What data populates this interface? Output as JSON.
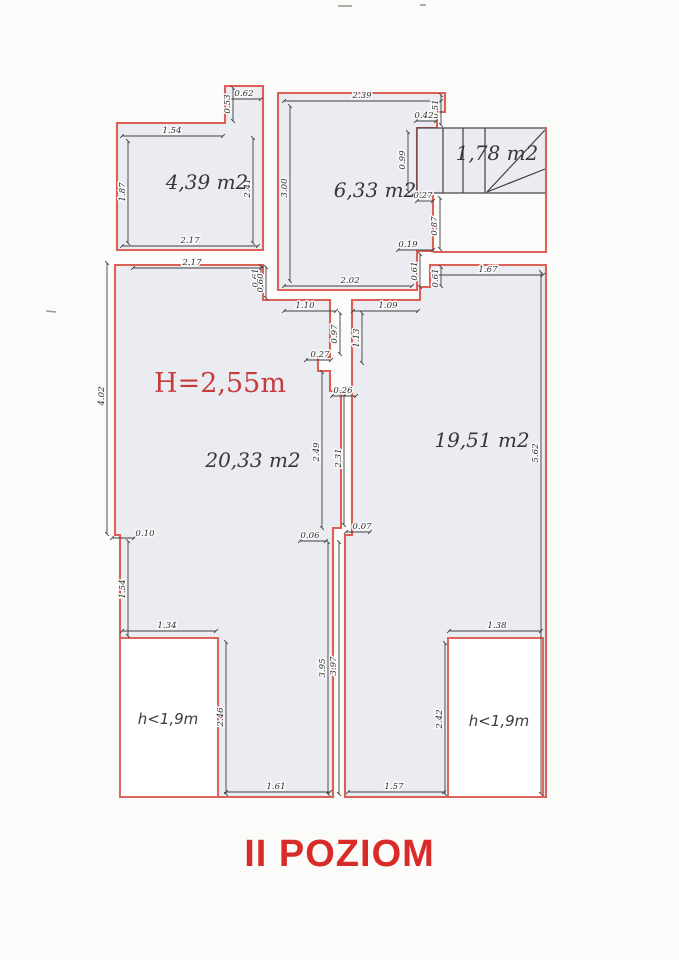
{
  "title": "II POZIOM",
  "height_label": "H=2,55m",
  "rooms": {
    "top_left": {
      "area": "4,39 m2"
    },
    "top_middle": {
      "area": "6,33 m2"
    },
    "stairs": {
      "area": "1,78 m2"
    },
    "left": {
      "area": "20,33 m2"
    },
    "right": {
      "area": "19,51 m2"
    },
    "closet_left": {
      "label": "h<1,9m"
    },
    "closet_right": {
      "label": "h<1,9m"
    }
  },
  "dimensions": {
    "a_notch_w": "0.62",
    "a_notch_h": "0.53",
    "a_top": "1.54",
    "a_left": "1.87",
    "a_right": "2.41",
    "a_bottom": "2.17",
    "b_top": "2.39",
    "b_left": "3.00",
    "b_bottom": "2.02",
    "b_notch_h": "0.51",
    "b_notch_w": "0.42",
    "b_stair": "0.99",
    "b_step1": "0.27",
    "b_landing": "0.87",
    "b_step2": "0.19",
    "b_step3": "0.61",
    "mid_left_step": "0.61",
    "mid_open_left": "1.10",
    "mid_open_right": "1.09",
    "mid_wall_left": "0.97",
    "mid_wall_right": "1.13",
    "mid_step1": "0.27",
    "mid_step2": "0.26",
    "shaft_left": "2.49",
    "shaft_right": "2.31",
    "shaft_step_r": "0.07",
    "shaft_step_l": "0.06",
    "c_top": "2.17",
    "c_step": "0.60",
    "c_left": "4.02",
    "c_wall_step": "0.10",
    "c_left_lower": "1.54",
    "c_closet_top": "1.34",
    "c_closet_right": "2.46",
    "c_bottom": "1.61",
    "c_mid": "3.95",
    "d_top": "1.67",
    "d_notch": "0.61",
    "d_right": "5.62",
    "d_mid": "3.97",
    "d_closet_top": "1.38",
    "d_closet_left": "2.42",
    "d_bottom": "1.57"
  },
  "colors": {
    "wall_red": "#dd6057",
    "title_red": "#d92b27",
    "height_red": "#c63c3c",
    "room_fill": "#ebecf1",
    "line_black": "#3f3f44",
    "page_bg": "#fbfbfa"
  }
}
